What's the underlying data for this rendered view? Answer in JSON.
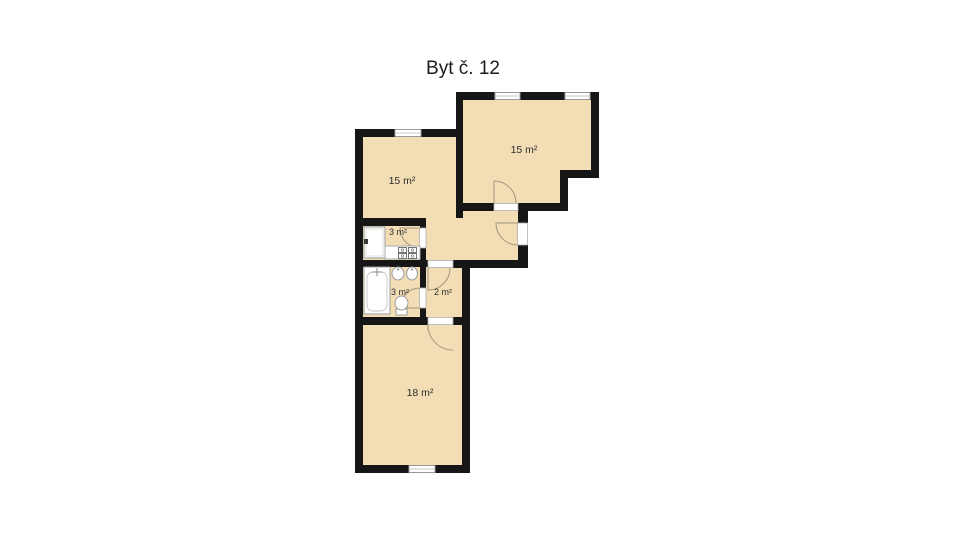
{
  "title": "Byt č. 12",
  "rooms": [
    {
      "id": "room-top-left",
      "area": "15 m²"
    },
    {
      "id": "room-top-right",
      "area": "15 m²"
    },
    {
      "id": "kitchen",
      "area": "3 m²"
    },
    {
      "id": "bathroom",
      "area": "3 m²"
    },
    {
      "id": "vestibule",
      "area": "2 m²"
    },
    {
      "id": "room-bottom",
      "area": "18 m²"
    }
  ],
  "colors": {
    "floor": "#f2ddb5",
    "wall": "#161616",
    "background": "#ffffff",
    "fixture_stroke": "#9a9a9a",
    "door_arc": "#a09880",
    "label_text": "#2e2e2e"
  },
  "icons": {
    "window-icon": "white gap with double frame lines",
    "door-swing-icon": "quarter-circle arc",
    "fridge-icon": "white rectangle with handle tick",
    "stove-icon": "2x2 burner grid",
    "bathtub-icon": "rounded inner rectangle with faucet cross",
    "sink-icon": "oval basin with tap dot",
    "toilet-icon": "bowl with cistern"
  }
}
